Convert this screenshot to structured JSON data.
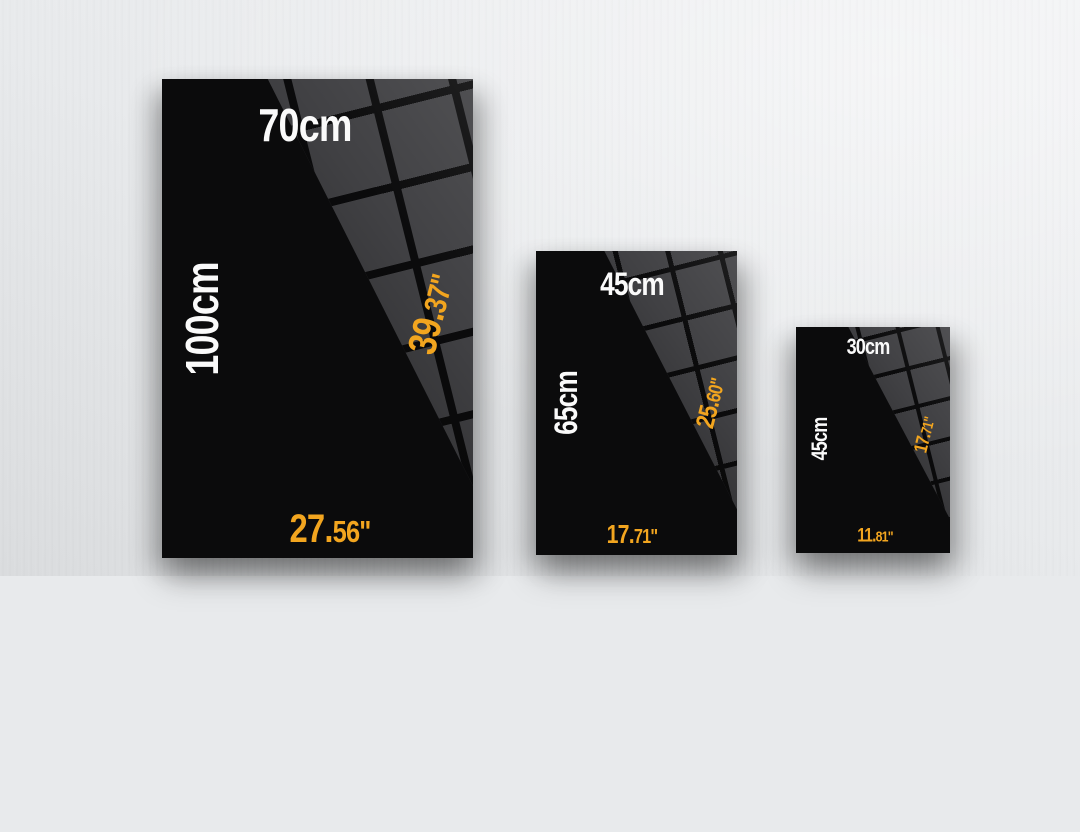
{
  "colors": {
    "accent_orange": "#F2A51F",
    "label_white": "#FAFAFA",
    "poster_black": "#0B0B0C",
    "pattern_gray": "#414144",
    "wall_gray": "#E8EAEC"
  },
  "posters": [
    {
      "width_cm": "70cm",
      "height_cm": "100cm",
      "height_in_main": "39.",
      "height_in_suffix": "37\"",
      "width_in_main": "27.",
      "width_in_suffix": "56\""
    },
    {
      "width_cm": "45cm",
      "height_cm": "65cm",
      "height_in_main": "25.",
      "height_in_suffix": "60\"",
      "width_in_main": "17.",
      "width_in_suffix": "71\""
    },
    {
      "width_cm": "30cm",
      "height_cm": "45cm",
      "height_in_main": "17.",
      "height_in_suffix": "71\"",
      "width_in_main": "11.",
      "width_in_suffix": "81\""
    }
  ]
}
